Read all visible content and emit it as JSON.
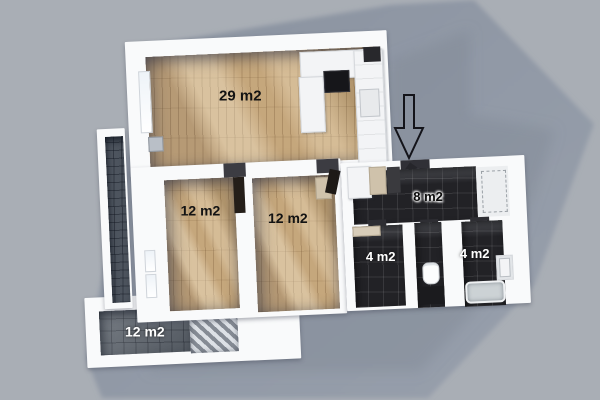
{
  "scene": {
    "description": "3D rendered top-down floor plan of an apartment with cast shadow on gray background",
    "background_color": "#a9aeb5",
    "shadow_color": "#8d95a2",
    "wall_color": "#f9fafb",
    "wood_floor_color": "#c9aa7e",
    "dark_tile_color": "#222226",
    "terrace_tile_color": "#5d646d"
  },
  "rooms": [
    {
      "id": "living-kitchen",
      "label": "29 m2",
      "floor": "wood"
    },
    {
      "id": "bedroom-left",
      "label": "12 m2",
      "floor": "wood"
    },
    {
      "id": "bedroom-right",
      "label": "12 m2",
      "floor": "wood"
    },
    {
      "id": "hallway",
      "label": "8 m2",
      "floor": "dark-tile"
    },
    {
      "id": "bathroom-left",
      "label": "4 m2",
      "floor": "dark-tile"
    },
    {
      "id": "bathroom-right",
      "label": "4 m2",
      "floor": "dark-tile"
    },
    {
      "id": "terrace",
      "label": "12 m2",
      "floor": "gray-tile"
    }
  ],
  "annotations": {
    "entrance_arrow": {
      "shape": "down-arrow-outline",
      "meaning": "entrance direction indicator"
    }
  },
  "fixtures": [
    "kitchen-counter",
    "cooktop",
    "fridge",
    "wardrobe",
    "toilet",
    "bathtub",
    "washing-machine",
    "balcony-railing",
    "windows"
  ]
}
